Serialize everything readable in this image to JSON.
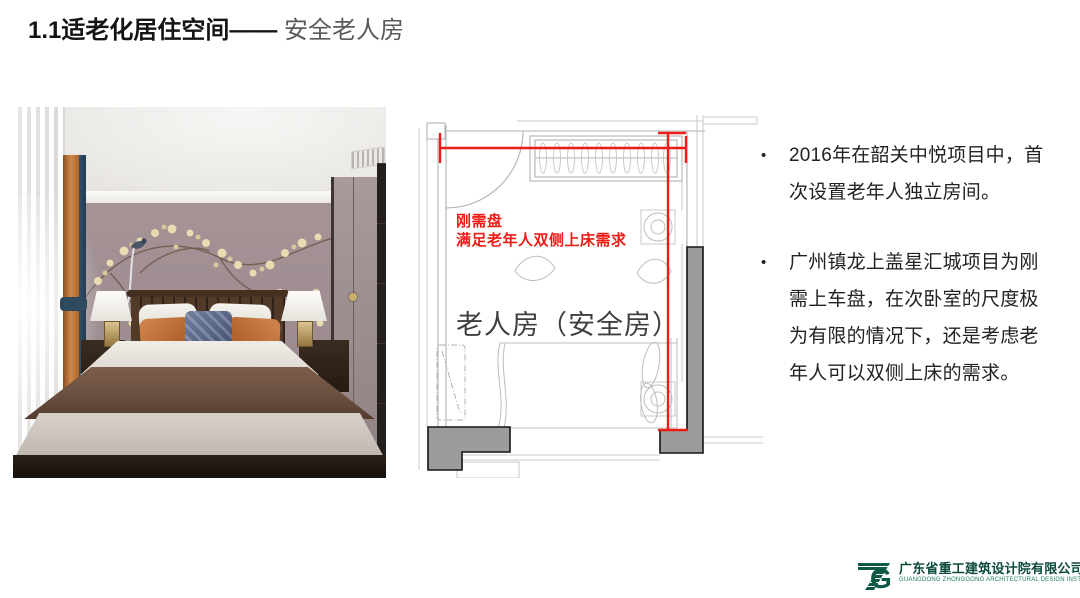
{
  "slide_title": {
    "primary": "1.1适老化居住空间——",
    "secondary": " 安全老人房"
  },
  "plan": {
    "note_line1": "刚需盘",
    "note_line2": "满足老年人双侧上床需求",
    "room_label": "老人房（安全房）"
  },
  "bullets": [
    {
      "marker": "•",
      "text": "2016年在韶关中悦项目中，首次设置老年人独立房间。"
    },
    {
      "marker": "•",
      "text": "广州镇龙上盖星汇城项目为刚需上车盘，在次卧室的尺度极为有限的情况下，还是考虑老年人可以双侧上床的需求。"
    }
  ],
  "footer": {
    "company_cn": "广东省重工建筑设计院有限公司",
    "company_en": "GUANGDONG ZHONGGONG ARCHITECTURAL DESIGN INSTITUTE CO.,LTD."
  },
  "colors": {
    "annotation_red": "#ee1c16",
    "logo_green": "#0c5847",
    "title_gray": "#5a5a5a"
  }
}
